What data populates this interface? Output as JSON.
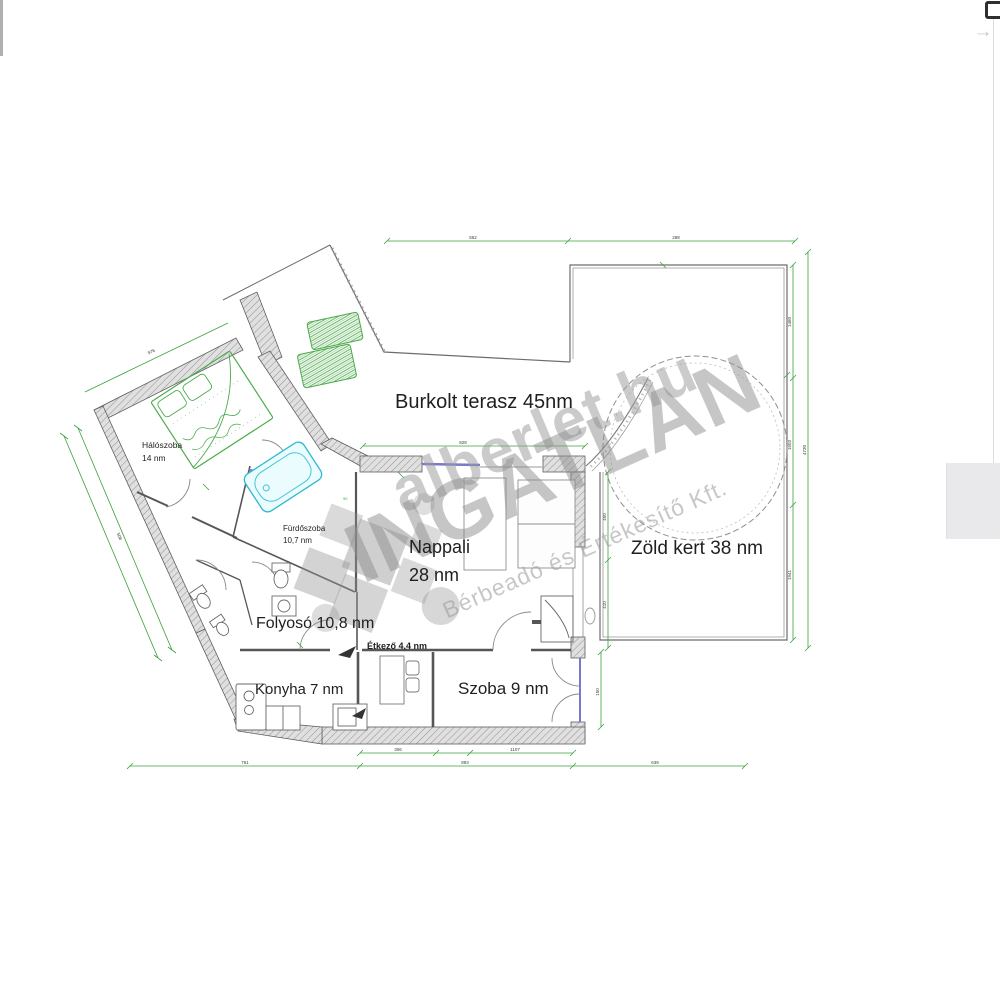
{
  "viewer": {
    "next_arrow": "→"
  },
  "floorplan": {
    "rooms": {
      "terrace": "Burkolt terasz 45nm",
      "garden": "Zöld kert 38 nm",
      "living_1": "Nappali",
      "living_2": "28 nm",
      "hallway": "Folyosó 10,8 nm",
      "kitchen": "Konyha 7 nm",
      "room": "Szoba 9 nm",
      "dining": "Étkező 4,4 nm",
      "bathroom_1": "Fürdőszoba",
      "bathroom_2": "10,7 nm",
      "bedroom_1": "Hálószoba",
      "bedroom_2": "14 nm"
    },
    "watermark": {
      "site": "alberlet.hu",
      "brand": "INGATLAN",
      "tagline": "Bérbeadó és Értékesítő Kft."
    },
    "dims": {
      "top_a": "562",
      "top_b": "288",
      "right_a": "1460",
      "right_b": "1503",
      "right_c": "1941",
      "right_total": "4730",
      "left_a": "508",
      "left_b": "976",
      "wall_a": "828",
      "bottom_a": "306",
      "bottom_b": "1107",
      "bottom_c": "761",
      "bottom_d": "893",
      "bottom_e": "639",
      "inner_a": "450",
      "inner_b": "410",
      "inner_c": "150",
      "door_a": "90"
    }
  }
}
